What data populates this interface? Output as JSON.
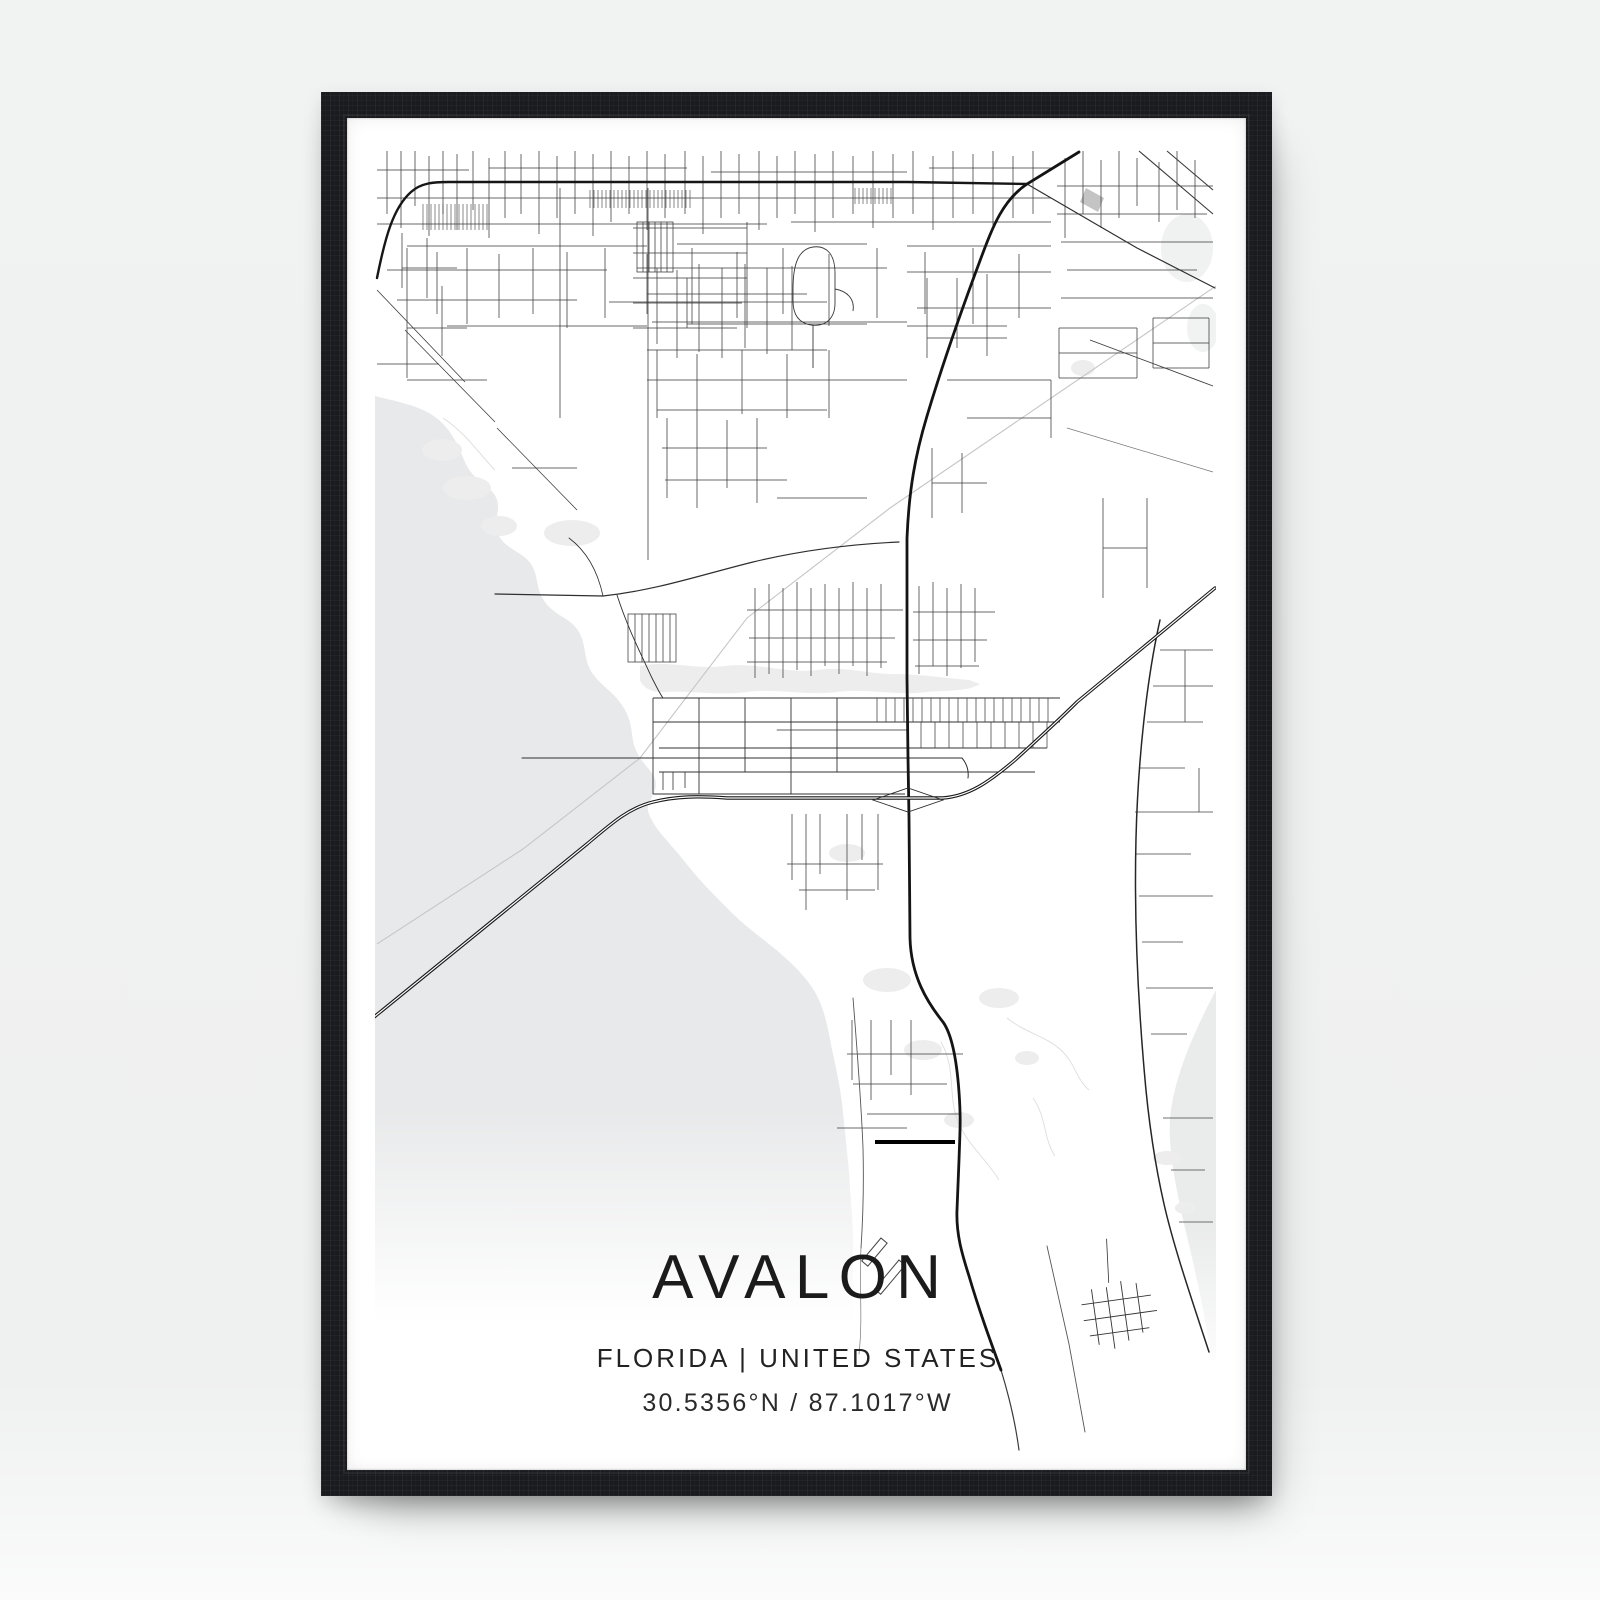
{
  "poster": {
    "title": "AVALON",
    "subtitle": "FLORIDA | UNITED STATES",
    "coordinates": "30.5356°N / 87.1017°W"
  },
  "colors": {
    "wall": "#f0f1f1",
    "frame": "#191b1e",
    "paper": "#ffffff",
    "water": "#e8e9ea",
    "marsh": "#ededed",
    "road_major": "#141414",
    "road_minor": "#3a3a3a",
    "railroad": "#c6c6c6",
    "text": "#1b1b1b"
  }
}
